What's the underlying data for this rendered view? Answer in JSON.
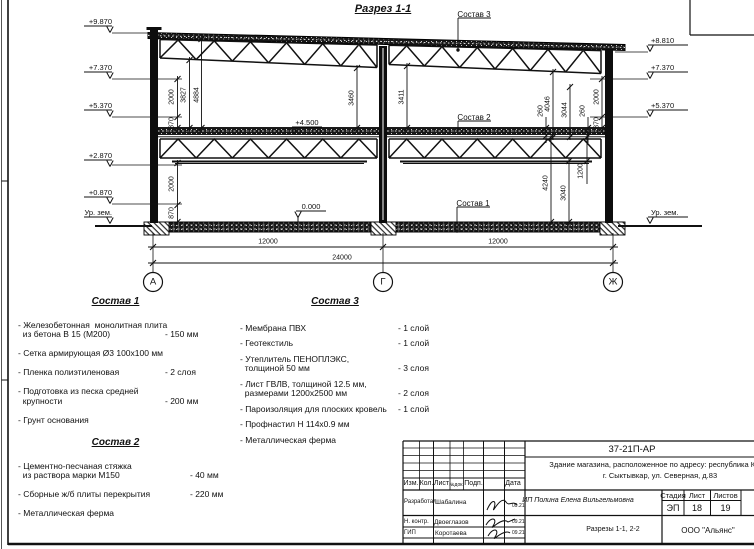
{
  "drawing": {
    "title": "Разрез 1-1",
    "section_labels": [
      "Состав 3",
      "Состав 2",
      "Состав 1"
    ],
    "level_marks": [
      "+4.500",
      "0.000"
    ],
    "elevations_left": [
      "+9.870",
      "+7.370",
      "+5.370",
      "+2.870",
      "+0.870",
      "Ур. зем."
    ],
    "elevations_right": [
      "+8.810",
      "+7.370",
      "+5.370",
      "Ур. зем."
    ],
    "dims_vertical": [
      "2000",
      "870",
      "3827",
      "4884",
      "2000",
      "870",
      "3460",
      "3411",
      "260",
      "4046",
      "3044",
      "260",
      "2000",
      "870",
      "4240",
      "3040",
      "1200"
    ],
    "dims_horizontal": [
      "12000",
      "12000",
      "24000"
    ],
    "axes": [
      "А",
      "Г",
      "Ж"
    ]
  },
  "spec1": {
    "title": "Состав 1",
    "items": [
      {
        "name": "- Железобетонная  монолитная плита\n  из бетона В 15 (М200)",
        "value": "- 150 мм"
      },
      {
        "name": "- Сетка армирующая Ø3 100х100 мм",
        "value": ""
      },
      {
        "name": "- Пленка полиэтиленовая",
        "value": "-  2 слоя"
      },
      {
        "name": "- Подготовка из песка средней\n  крупности",
        "value": "- 200 мм"
      },
      {
        "name": "- Грунт основания",
        "value": ""
      }
    ]
  },
  "spec2": {
    "title": "Состав 2",
    "items": [
      {
        "name": "- Цементно-песчаная стяжка\n  из раствора марки М150",
        "value": "- 40 мм"
      },
      {
        "name": "- Сборные ж/б плиты перекрытия",
        "value": "- 220 мм"
      },
      {
        "name": "- Металлическая ферма",
        "value": ""
      }
    ]
  },
  "spec3": {
    "title": "Состав 3",
    "items": [
      {
        "name": "- Мембрана ПВХ",
        "value": "- 1 слой"
      },
      {
        "name": "- Геотекстиль",
        "value": "- 1 слой"
      },
      {
        "name": "- Утеплитель ПЕНОПЛЭКС,\n  толщиной 50 мм",
        "value": "- 3 слоя"
      },
      {
        "name": "- Лист ГВЛВ, толщиной 12.5 мм,\n  размерами 1200х2500 мм",
        "value": "- 2 слоя"
      },
      {
        "name": "- Пароизоляция для плоских кровель",
        "value": "- 1 слой"
      },
      {
        "name": "- Профнастил Н 114х0.9 мм",
        "value": ""
      },
      {
        "name": "- Металлическая ферма",
        "value": ""
      }
    ]
  },
  "titleblock": {
    "doc_number": "37-21П-АР",
    "object_line1": "Здание магазина, расположенное по адресу: республика Коми,",
    "object_line2": "г. Сыктывкар, ул. Северная, д.83",
    "columns": [
      "Изм.",
      "Кол.",
      "Лист",
      "№док.",
      "Подп.",
      "Дата"
    ],
    "signature_rows": [
      {
        "role": "Разработал",
        "name": "Шабалина",
        "date": "09.21"
      },
      {
        "role": "Н. контр.",
        "name": "Двоеглазов",
        "date": "09.21"
      },
      {
        "role": "ГИП",
        "name": "Коротаева",
        "date": "09.21"
      }
    ],
    "designer": "ИП Полина Елена Вильгельмовна",
    "stage_label": "Стадия",
    "sheet_label": "Лист",
    "sheets_label": "Листов",
    "stage": "ЭП",
    "sheet_number": "18",
    "sheets_total": "19",
    "sheet_title": "Разрезы 1-1, 2-2",
    "organization": "ООО \"Альянс\""
  }
}
